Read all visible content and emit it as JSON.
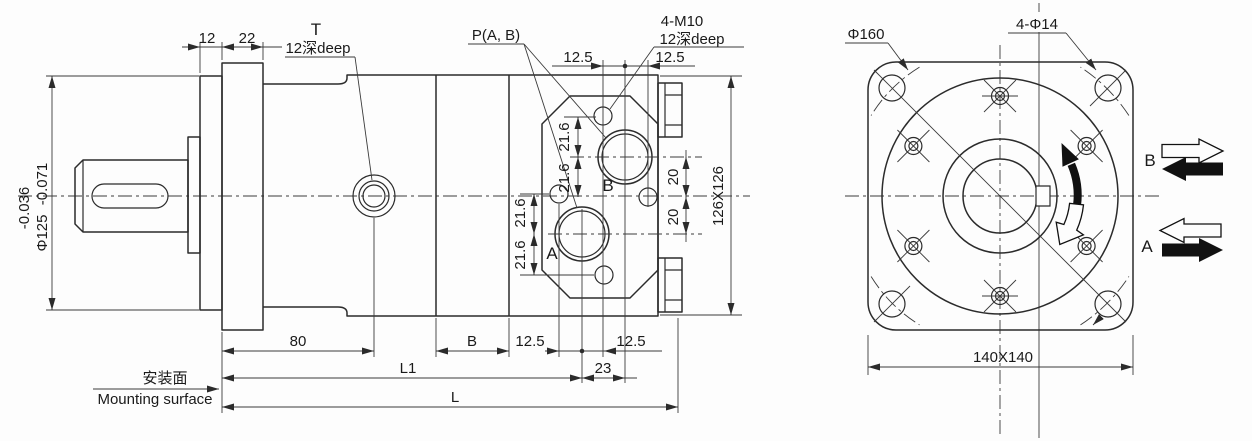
{
  "side_view": {
    "dims": {
      "d12": "12",
      "d22": "22",
      "d12_5": "12.5",
      "d21_6": "21.6",
      "d20": "20",
      "square126": "126X126",
      "d80": "80",
      "dB": "B",
      "dL1": "L1",
      "dL": "L",
      "d23": "23",
      "shaft_dia": "Φ125",
      "tol_upper": "-0.036",
      "tol_lower": "-0.071"
    },
    "labels": {
      "t_port": "T",
      "depth_note": "12深deep",
      "ports_note": "P(A, B)",
      "m10_note": "4-M10",
      "port_a": "A",
      "port_b": "B",
      "mount_cn": "安装面",
      "mount_en": "Mounting surface"
    }
  },
  "front_view": {
    "dims": {
      "bolt_circle": "Φ160",
      "corner_holes": "4-Φ14",
      "square140": "140X140"
    },
    "labels": {
      "line_a": "A",
      "line_b": "B"
    }
  }
}
